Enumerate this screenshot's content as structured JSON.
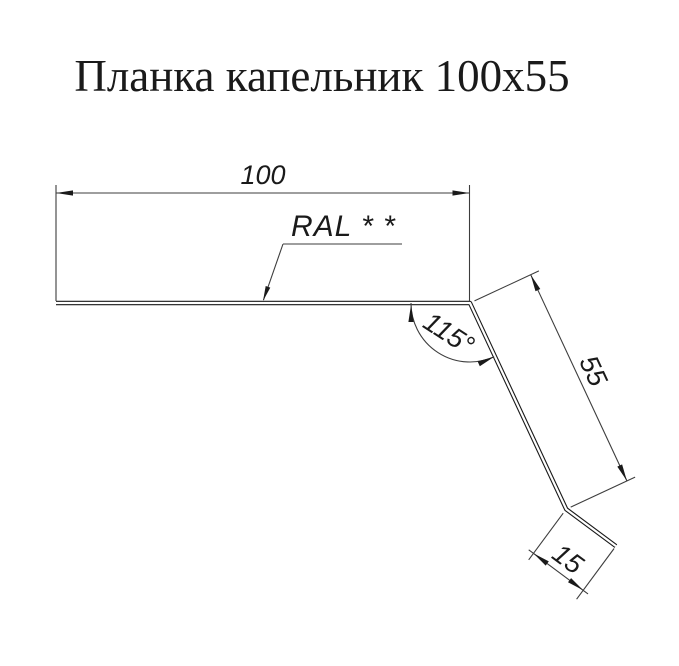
{
  "title": "Планка капельник 100x55",
  "dims": {
    "width": "100",
    "side": "55",
    "lip": "15",
    "angle": "115°"
  },
  "coating_label": "RAL * *",
  "profile": {
    "part_type": "drip edge flashing (планка капельник)",
    "width_mm": 100,
    "side_mm": 55,
    "lip_mm": 15,
    "bend_angle_deg": 115
  },
  "colors": {
    "paper": "#ffffff",
    "ink": "#1a1a1a",
    "thin": "#3d3d3d"
  }
}
